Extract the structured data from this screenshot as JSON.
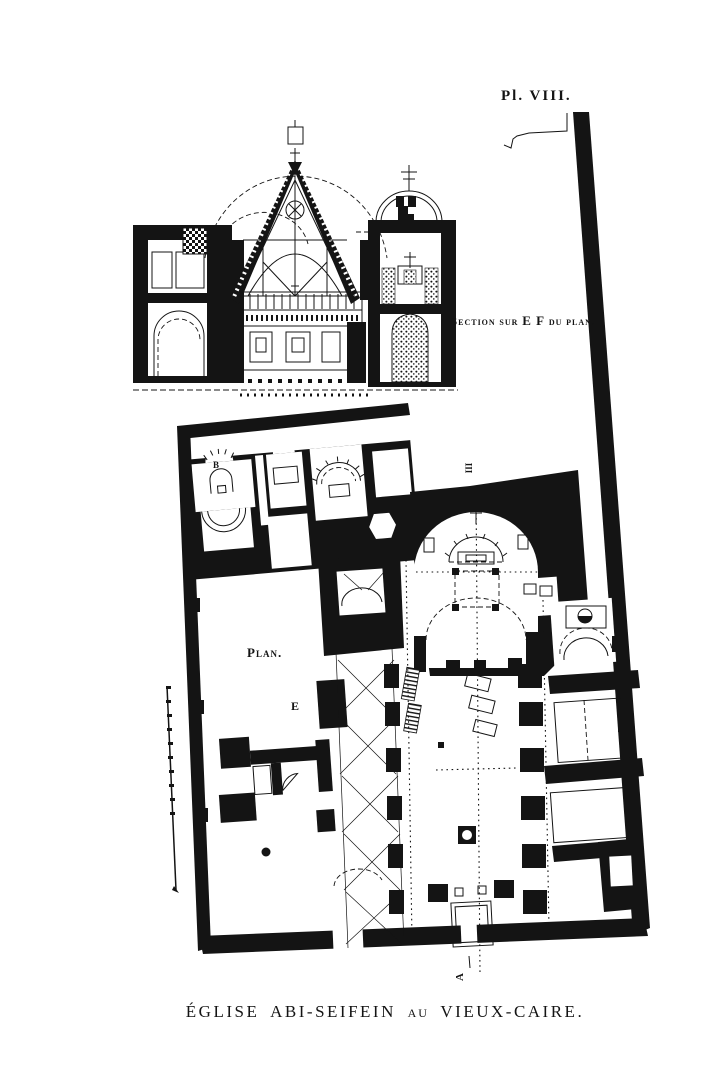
{
  "plate": {
    "number": "Pl. VIII.",
    "section_label": {
      "part1": "Section sur",
      "ef": "E F",
      "part2": "du plan."
    },
    "plan_label": "Plan.",
    "caption": {
      "part1": "ÉGLISE ABI-SEIFEIN",
      "connector": "AU",
      "part2": "VIEUX-CAIRE."
    },
    "markers": {
      "b": "B",
      "e": "E",
      "iii": "III",
      "a": "A"
    },
    "colors": {
      "ink": "#141414",
      "paper": "#ffffff"
    }
  }
}
